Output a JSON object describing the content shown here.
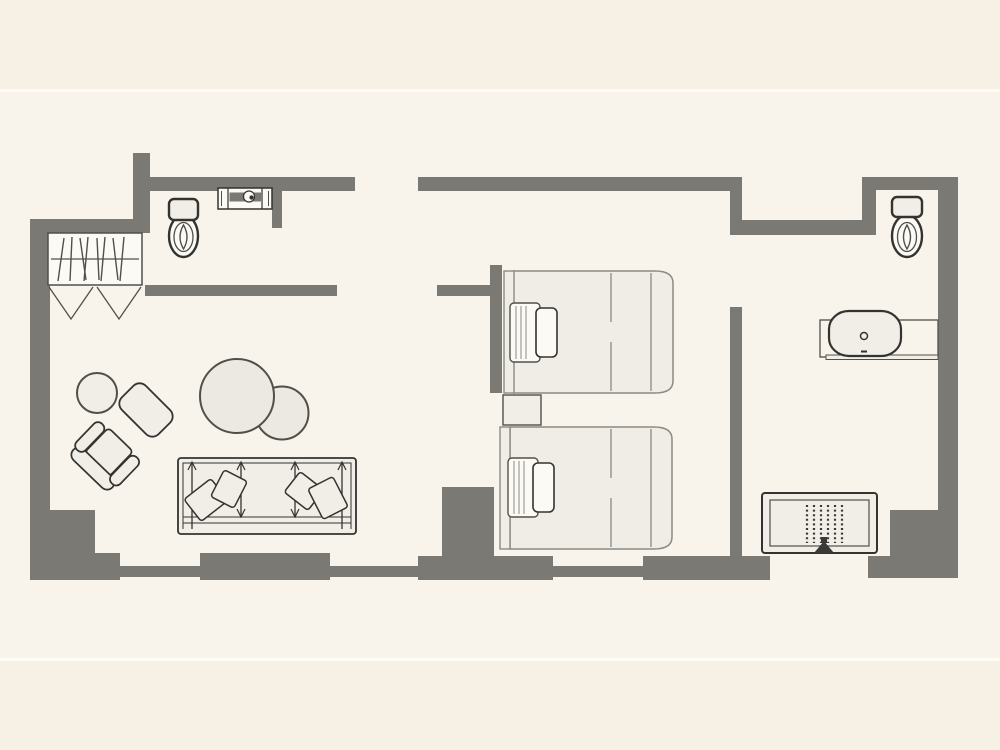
{
  "meta": {
    "description": "hotel guest room floor plan, no text labels visible",
    "plan_type": "floorplan"
  },
  "colors": {
    "floor": "#f8f4ec",
    "band": "#f7f0e5",
    "band_line": "#fffdf8",
    "wall": "#7b7973",
    "outline_dark": "#34332f",
    "outline_mid": "#504f4a",
    "outline_soft": "#8b8a84",
    "fill_light": "#f1eee7",
    "fill_bed": "#efede6",
    "fill_table": "#ebe9e1",
    "fill_white": "#fcfaf4",
    "strap_dark": "#3a3935"
  },
  "rooms": {
    "entry": [
      "closet-with-hangers",
      "bifold-doors",
      "toilet",
      "vanity-counter-with-sink"
    ],
    "living_area": [
      "armchair",
      "ottoman",
      "side-table",
      "coffee-table-large",
      "coffee-table-small",
      "sofa-bed"
    ],
    "sleeping_area": [
      "bed-upper",
      "nightstand",
      "bed-lower"
    ],
    "bathroom": [
      "toilet",
      "sink-on-counter"
    ],
    "hall": [
      "luggage-bench"
    ]
  },
  "openings": [
    "entry-door-top-wall",
    "living-area-doorway",
    "bathroom-doorway",
    "bottom-wall-opening"
  ]
}
